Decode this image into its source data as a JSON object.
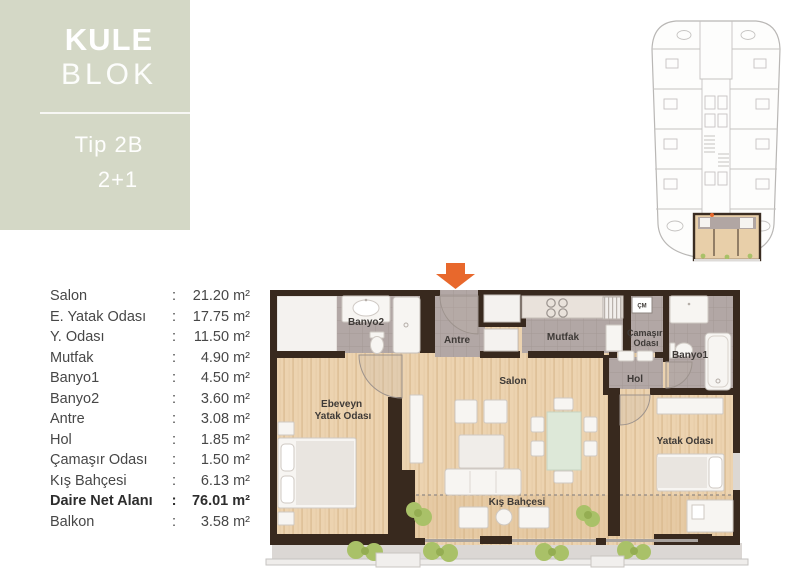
{
  "panel": {
    "brand_top": "KULE",
    "brand_bottom": "BLOK",
    "unit_type": "Tip 2B",
    "unit_layout": "2+1"
  },
  "area_table": {
    "separator": ":",
    "unit_suffix": "m²",
    "rows": [
      {
        "label": "Salon",
        "value": "21.20 m²"
      },
      {
        "label": "E. Yatak Odası",
        "value": "17.75 m²"
      },
      {
        "label": "Y. Odası",
        "value": "11.50 m²"
      },
      {
        "label": "Mutfak",
        "value": "4.90 m²"
      },
      {
        "label": "Banyo1",
        "value": "4.50 m²"
      },
      {
        "label": "Banyo2",
        "value": "3.60 m²"
      },
      {
        "label": "Antre",
        "value": "3.08 m²"
      },
      {
        "label": "Hol",
        "value": "1.85 m²"
      },
      {
        "label": "Çamaşır Odası",
        "value": "1.50 m²"
      },
      {
        "label": "Kış Bahçesi",
        "value": "6.13 m²"
      },
      {
        "label": "Daire Net Alanı",
        "value": "76.01 m²",
        "emphasis": true
      },
      {
        "label": "Balkon",
        "value": "3.58 m²"
      }
    ]
  },
  "floorplan": {
    "labels": {
      "banyo2": "Banyo2",
      "antre": "Antre",
      "mutfak": "Mutfak",
      "camasir_line1": "Çamaşır",
      "camasir_line2": "Odası",
      "banyo1": "Banyo1",
      "hol": "Hol",
      "salon": "Salon",
      "ebeveyn_line1": "Ebeveyn",
      "ebeveyn_line2": "Yatak Odası",
      "yatak": "Yatak Odası",
      "kis_bahcesi": "Kış Bahçesi",
      "cm": "ÇM"
    }
  },
  "colors": {
    "panel_green": "#d4d8c6",
    "wall_dark": "#38291e",
    "wood_floor": "#ecd3b0",
    "wet_room_tile": "#b2a7a5",
    "balcony_gray": "#dbd7d4",
    "fixture_white": "#f7f5f2",
    "plant_green": "#a9c168",
    "accent_orange": "#e8682c",
    "dining_table_green": "#dde8d8",
    "keyplan_line": "#c0bebc",
    "label_text": "#3e3a37",
    "list_text": "#474747"
  }
}
